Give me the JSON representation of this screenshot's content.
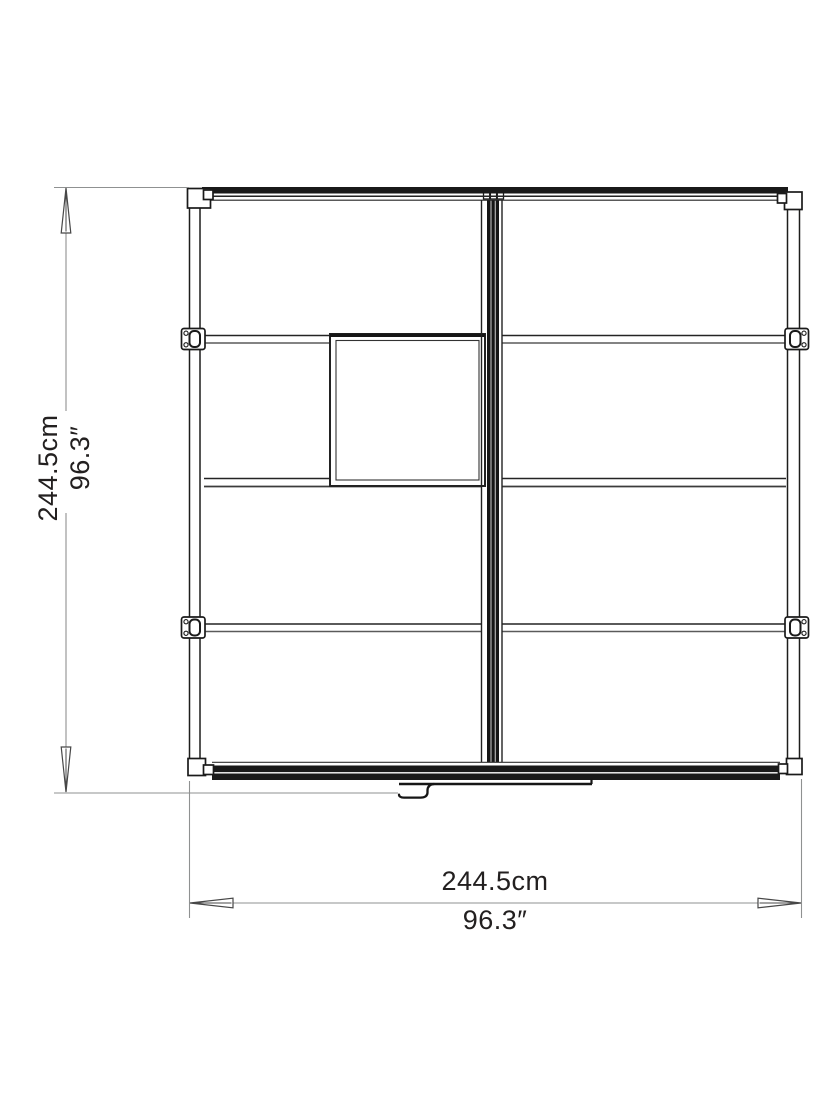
{
  "diagram": {
    "name": "floor-plan-top-view",
    "height": {
      "cm": "244.5cm",
      "inches": "96.3″"
    },
    "width": {
      "cm": "244.5cm",
      "inches": "96.3″"
    }
  },
  "colors": {
    "frame": "#1d1d1b",
    "dimension_line": "#8f9191",
    "arrow_outline": "#474747",
    "label_text": "#232020",
    "background": "#ffffff"
  }
}
